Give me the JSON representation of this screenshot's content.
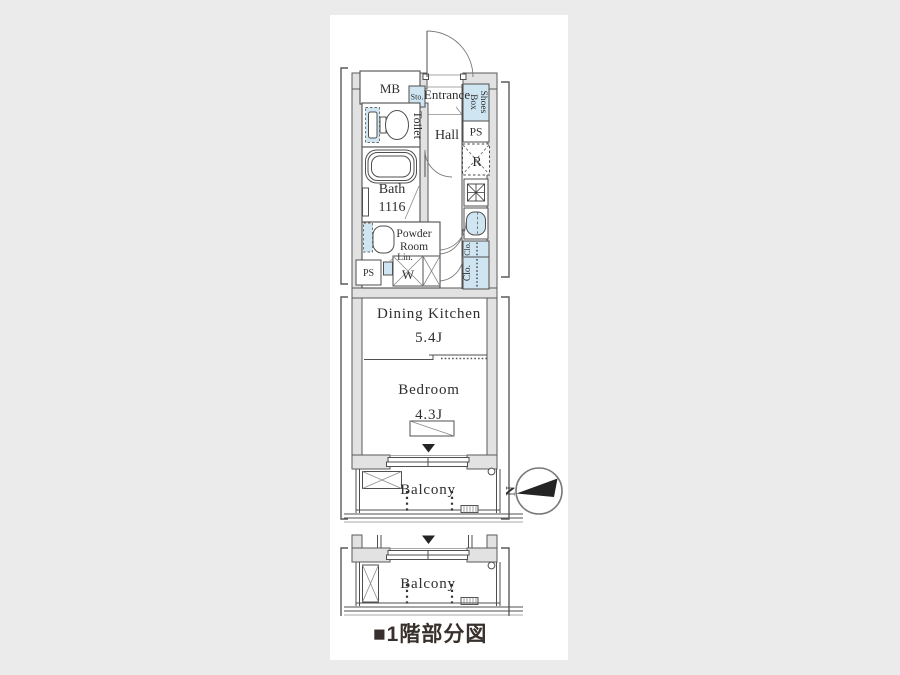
{
  "palette": {
    "background": "#ebebeb",
    "panel_background": "#ffffff",
    "wall_fill": "#e2e2e2",
    "line_color": "#4f4f4f",
    "fixture_blue": "#cfe6f2",
    "needle_black": "#242424"
  },
  "labels": {
    "mb": "MB",
    "storage": "Sto.",
    "entrance": "Entrance",
    "shoes_box": {
      "line1": "Shoes",
      "line2": "Box"
    },
    "toilet": "Toilet",
    "hall": "Hall",
    "ps_upper": "PS",
    "refrigerator": "R",
    "bath": {
      "name": "Bath",
      "size": "1116"
    },
    "powder_room": {
      "line1": "Powder",
      "line2": "Room"
    },
    "linen": "Lin.",
    "washer": "W",
    "ps_lower": "PS",
    "closet_upper": "Clo.",
    "closet_lower": "Clo.",
    "dining_kitchen": {
      "name": "Dining Kitchen",
      "size": "5.4J"
    },
    "bedroom": {
      "name": "Bedroom",
      "size": "4.3J"
    },
    "balcony_main": "Balcony",
    "balcony_lower": "Balcony"
  },
  "compass": {
    "north": "N"
  },
  "caption": "■1階部分図"
}
